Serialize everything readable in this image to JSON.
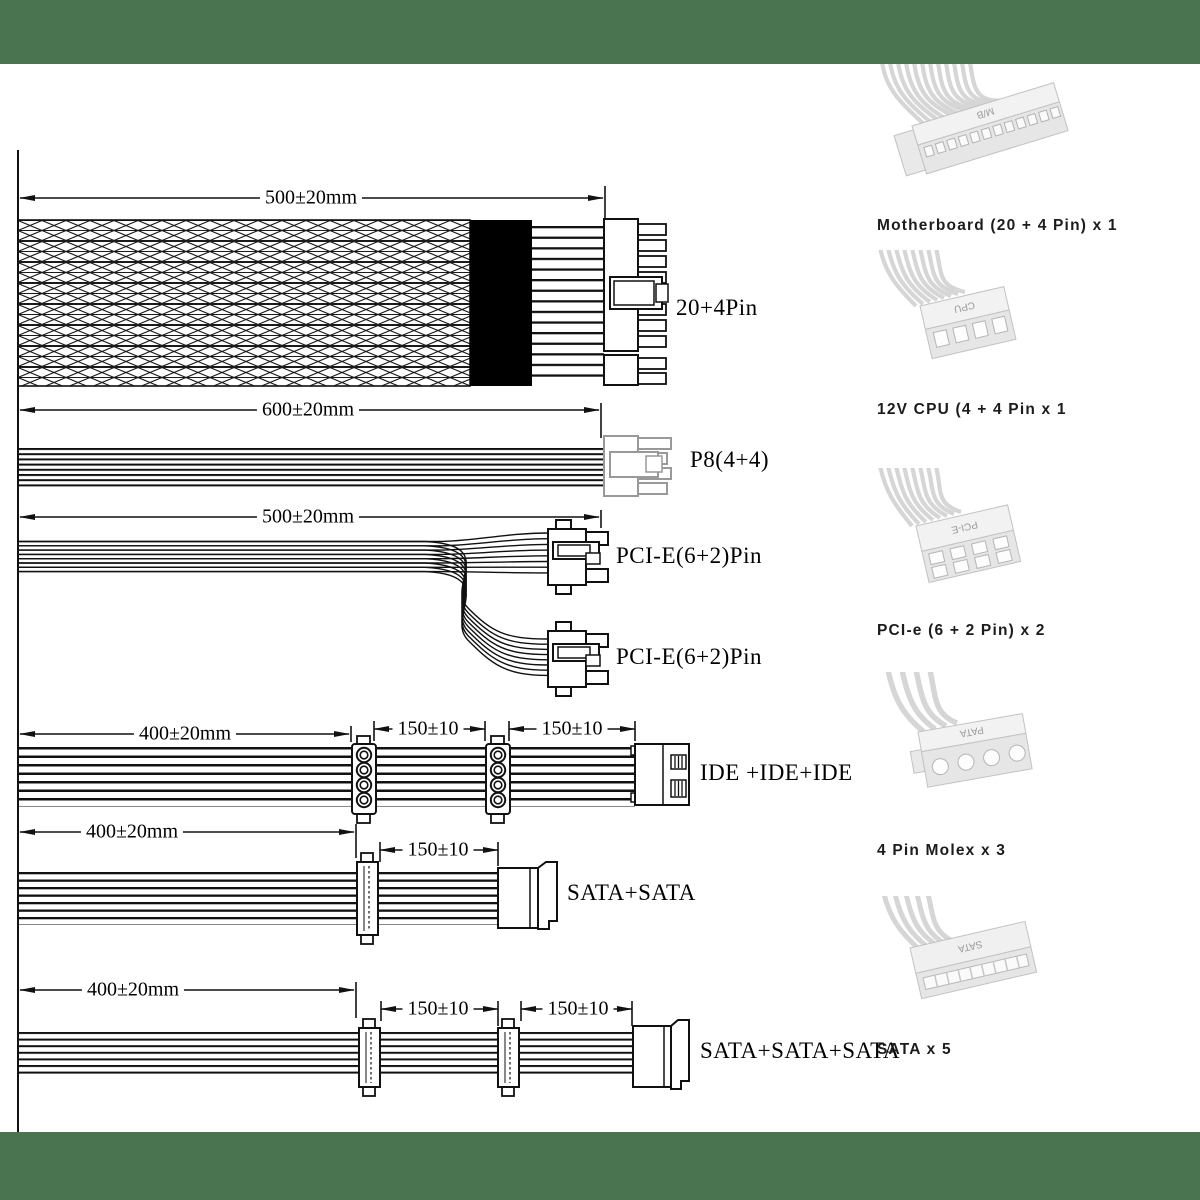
{
  "colors": {
    "band_green": "#4a7350",
    "line_black": "#111111",
    "p8_connector_gray": "#999999",
    "photo_gray": "#e8e8e8"
  },
  "diagram": {
    "dims": {
      "atx": "500±20mm",
      "p8": "600±20mm",
      "pcie": "500±20mm",
      "ide_a": "400±20mm",
      "ide_b": "150±10",
      "ide_c": "150±10",
      "sata2_a": "400±20mm",
      "sata2_b": "150±10",
      "sata3_a": "400±20mm",
      "sata3_b": "150±10",
      "sata3_c": "150±10"
    },
    "labels": {
      "atx": "20+4Pin",
      "p8": "P8(4+4)",
      "pcie_top": "PCI-E(6+2)Pin",
      "pcie_bottom": "PCI-E(6+2)Pin",
      "ide": "IDE +IDE+IDE",
      "sata2": "SATA+SATA",
      "sata3": "SATA+SATA+SATA"
    }
  },
  "legend": {
    "items": [
      {
        "caption": "Motherboard (20 + 4 Pin) x 1",
        "chip": "M/B"
      },
      {
        "caption": "12V CPU (4 + 4 Pin x 1",
        "chip": "CPU"
      },
      {
        "caption": "PCI-e (6 + 2 Pin) x 2",
        "chip": "PCI-E"
      },
      {
        "caption": "4 Pin Molex x 3",
        "chip": "PATA"
      },
      {
        "caption": "SATA x 5",
        "chip": "SATA"
      }
    ]
  }
}
